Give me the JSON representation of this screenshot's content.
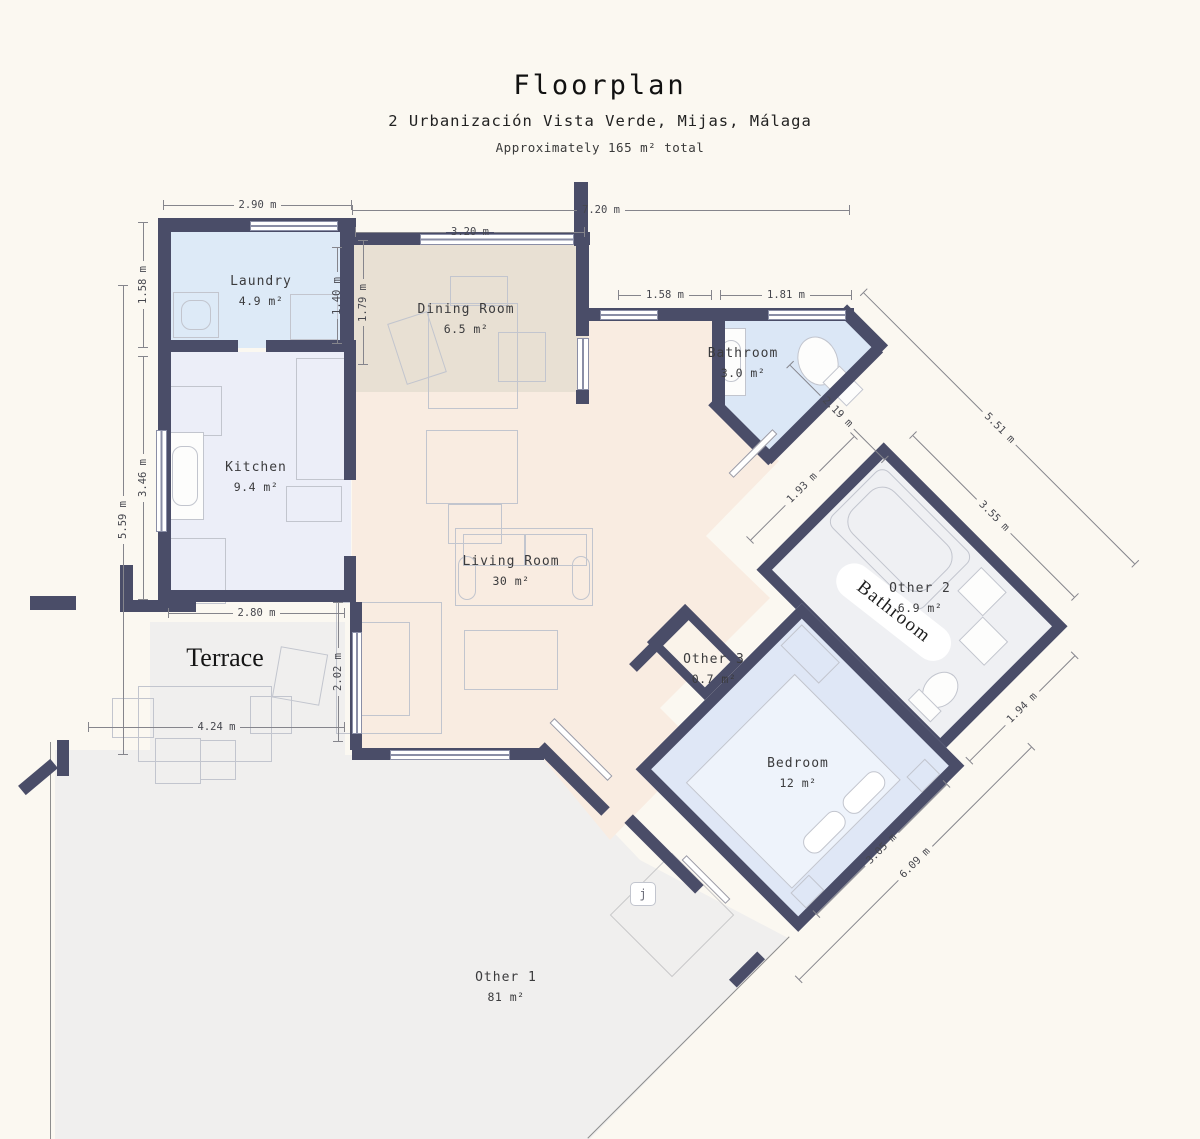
{
  "header": {
    "title": "Floorplan",
    "subtitle": "2 Urbanización Vista Verde, Mijas, Málaga",
    "note": "Approximately 165 m² total"
  },
  "rooms": {
    "laundry": {
      "label": "Laundry",
      "area": "4.9 m²"
    },
    "dining": {
      "label": "Dining Room",
      "area": "6.5 m²"
    },
    "kitchen": {
      "label": "Kitchen",
      "area": "9.4 m²"
    },
    "living": {
      "label": "Living Room",
      "area": "30 m²"
    },
    "bathroom": {
      "label": "Bathroom",
      "area": "3.0 m²"
    },
    "other2": {
      "label": "Other 2",
      "area": "6.9 m²"
    },
    "other3": {
      "label": "Other 3",
      "area": "0.7 m²"
    },
    "bedroom": {
      "label": "Bedroom",
      "area": "12 m²"
    },
    "other1": {
      "label": "Other 1",
      "area": "81 m²"
    }
  },
  "annotations": {
    "terrace": "Terrace",
    "bathroom_serif": "Bathroom",
    "light_glyph": "j"
  },
  "dims": {
    "laundry_top": "2.90 m",
    "overall_top": "7.20 m",
    "dining_top": "3.20 m",
    "hall_top": "1.58 m",
    "bath_top": "1.81 m",
    "terrace_top": "2.80 m",
    "terrace_bottom": "4.24 m",
    "laundry_left": "1.58 m",
    "left_overall": "5.59 m",
    "kitchen_left": "3.46 m",
    "laundry_right": "1.40 m",
    "dining_left": "1.79 m",
    "terrace_right": "2.02 m",
    "bath_diag": "2.19 m",
    "right_overall": "5.51 m",
    "other2_nw": "1.93 m",
    "other2_ne": "3.55 m",
    "other2_se": "1.94 m",
    "bedroom_se": "6.09 m",
    "bedroom_inner": "3.05 m"
  },
  "colors": {
    "background": "#fbf8f1",
    "wall": "#4a4d68",
    "laundry_fill": "#ddeaf7",
    "kitchen_fill": "#eceef8",
    "dining_fill": "#e8e0d3",
    "living_fill": "#f9ece1",
    "bathroom_fill": "#dbe7f6",
    "bedroom_fill": "#dfe7f6",
    "other2_fill": "#eff0f3",
    "outdoor_fill": "#f0efee"
  }
}
